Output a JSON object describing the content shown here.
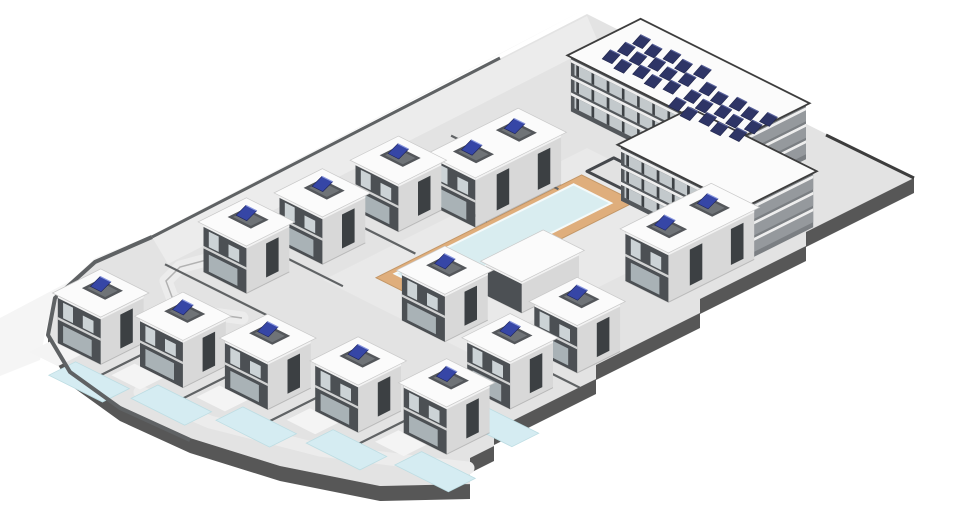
{
  "meta": {
    "canvas": {
      "w": 980,
      "h": 523
    }
  },
  "iso": {
    "ox": 587,
    "oy": 14,
    "ax": 0.894,
    "ay": 0.447
  },
  "palette": {
    "bg": "#ffffff",
    "terrain": "#f5f5f5",
    "plate": "#e3e3e3",
    "plate_side": "#575757",
    "road": "#ececec",
    "road_edge": "#9a9a9a",
    "plaza": "#e9e9e9",
    "deck": "#dfae7c",
    "deck_edge": "#c49767",
    "pool_water": "#d9edf0",
    "pool_edge": "#f4fafa",
    "front_pool": "#d5ecf2",
    "front_pool_edge": "#bddde3",
    "patio": "#f4f4f4",
    "wall": "#5f6264",
    "divider": "#606365",
    "face_sw": "#4c5054",
    "face_se": "#d8d8d8",
    "window_dark": "#3c4043",
    "window_light": "#ccd3d6",
    "glass": "#a9b2b6",
    "fascia": "#f2f2f2",
    "roof": "#fbfbfb",
    "roof_edge": "#c9c9c9",
    "well_wall": "#54575b",
    "well_floor": "#6f7377",
    "solar_house": "#3646a6",
    "solar_house_edge": "#1d2359",
    "solar_house_hi": "#8c9ae0",
    "apt_sw": "#53575b",
    "apt_se": "#7b7f83",
    "apt_bay": "#c3c9cc",
    "apt_pier": "#3e4246",
    "apt_slab": "#eeeeee",
    "parapet": "#3d3d3d",
    "solar_apt": "#2e3566",
    "solar_apt_edge": "#20254a",
    "court": "#45484c",
    "base_line": "rgba(0,0,0,0.16)"
  },
  "site": {
    "terrain_outline": [
      [
        0,
        318
      ],
      [
        587,
        8
      ],
      [
        152,
        235
      ],
      [
        95,
        258
      ],
      [
        55,
        296
      ],
      [
        45,
        333
      ],
      [
        40,
        360
      ],
      [
        0,
        376
      ]
    ],
    "plate_outline": [
      [
        152,
        237
      ],
      [
        587,
        14
      ],
      [
        914,
        178
      ],
      [
        806,
        232
      ],
      [
        806,
        246
      ],
      [
        700,
        299
      ],
      [
        700,
        313
      ],
      [
        596,
        365
      ],
      [
        596,
        379
      ],
      [
        494,
        430
      ],
      [
        494,
        446
      ],
      [
        470,
        458
      ],
      [
        470,
        484
      ],
      [
        380,
        486
      ],
      [
        280,
        466
      ],
      [
        190,
        438
      ],
      [
        120,
        406
      ],
      [
        70,
        370
      ],
      [
        48,
        333
      ],
      [
        56,
        296
      ],
      [
        95,
        260
      ]
    ],
    "south_boundary": [
      [
        914,
        178
      ],
      [
        806,
        232
      ],
      [
        806,
        246
      ],
      [
        700,
        299
      ],
      [
        700,
        313
      ],
      [
        596,
        365
      ],
      [
        596,
        379
      ],
      [
        494,
        430
      ],
      [
        494,
        446
      ],
      [
        470,
        458
      ],
      [
        470,
        484
      ],
      [
        380,
        486
      ],
      [
        280,
        466
      ],
      [
        190,
        438
      ],
      [
        120,
        406
      ],
      [
        70,
        370
      ],
      [
        48,
        333
      ]
    ],
    "band_h": 15,
    "nw_road": [
      [
        587,
        16
      ],
      [
        152,
        237
      ],
      [
        168,
        264
      ],
      [
        599,
        44
      ]
    ],
    "loop_road": [
      [
        242,
        318
      ],
      [
        198,
        312
      ],
      [
        172,
        297
      ],
      [
        166,
        281
      ],
      [
        180,
        267
      ],
      [
        210,
        259
      ],
      [
        242,
        261
      ]
    ],
    "bottom_path": [
      [
        140,
        392
      ],
      [
        210,
        422
      ],
      [
        320,
        450
      ],
      [
        430,
        464
      ],
      [
        468,
        468
      ]
    ],
    "nw_wall": [
      [
        500,
        58
      ],
      [
        152,
        237
      ]
    ],
    "west_curve_wall": [
      [
        152,
        237
      ],
      [
        95,
        262
      ],
      [
        55,
        298
      ],
      [
        48,
        335
      ],
      [
        70,
        372
      ],
      [
        120,
        408
      ],
      [
        190,
        440
      ]
    ],
    "ne_parapet": [
      [
        914,
        178
      ],
      [
        826,
        135
      ]
    ]
  },
  "plaza": {
    "u0": 150,
    "v0": 150,
    "u1": 445,
    "v1": 312
  },
  "deck": {
    "u0": 183,
    "v0": 177,
    "u1": 413,
    "v1": 237
  },
  "pool": {
    "u0": 198,
    "v0": 183,
    "u1": 398,
    "v1": 225
  },
  "courtyard": {
    "u0": 146,
    "v0": 176,
    "u1": 176,
    "v1": 266
  },
  "house_dims": {
    "single": {
      "du": 48,
      "dv": 48,
      "h": 50,
      "wells": [
        [
          -5,
          -3
        ]
      ]
    },
    "duplex": {
      "du": 96,
      "dv": 48,
      "h": 52,
      "wells": [
        [
          -24,
          -2
        ],
        [
          24,
          -2
        ]
      ]
    },
    "box": {
      "du": 64,
      "dv": 40,
      "h": 34,
      "wells": []
    }
  },
  "houses": [
    {
      "id": "house-1",
      "type": "single",
      "u": 479,
      "v": 98
    },
    {
      "id": "house-2",
      "type": "single",
      "u": 404,
      "v": 108
    },
    {
      "id": "house-3",
      "type": "single",
      "u": 325,
      "v": 114
    },
    {
      "id": "duplex-west",
      "type": "duplex",
      "u": 253,
      "v": 152
    },
    {
      "id": "house-4",
      "type": "single",
      "u": 422,
      "v": 263
    },
    {
      "id": "duplex-east",
      "type": "duplex",
      "u": 229,
      "v": 344
    },
    {
      "id": "house-5",
      "type": "single",
      "u": 383,
      "v": 372
    },
    {
      "id": "pool-house",
      "type": "box",
      "u": 339,
      "v": 278
    },
    {
      "id": "house-b1",
      "type": "single",
      "u": 640,
      "v": 96,
      "pool": true
    },
    {
      "id": "house-b2",
      "type": "single",
      "u": 620,
      "v": 168,
      "pool": true
    },
    {
      "id": "house-b3",
      "type": "single",
      "u": 597,
      "v": 240,
      "pool": true
    },
    {
      "id": "house-b4",
      "type": "single",
      "u": 572,
      "v": 316,
      "pool": true
    },
    {
      "id": "house-b5",
      "type": "single",
      "u": 547,
      "v": 390,
      "pool": true
    },
    {
      "id": "house-b6",
      "type": "single",
      "u": 461,
      "v": 375,
      "pool": true
    }
  ],
  "front_pool_dims": {
    "ou0": 35,
    "ov0": 7,
    "ou1": 65,
    "ov1": 67
  },
  "patio_dims": {
    "ou0": 24,
    "ov0": -30,
    "ou1": 50,
    "ov1": 2
  },
  "apartment": {
    "wings": [
      {
        "id": "apartment-wing-west",
        "u0": 40,
        "u1": 118,
        "v0": 100,
        "v1": 285,
        "h": 56,
        "cluster": {
          "u": 84,
          "v": 162,
          "rows": 3,
          "cols": 5,
          "step": 17
        }
      },
      {
        "id": "apartment-wing-east",
        "u0": 112,
        "u1": 190,
        "v0": 228,
        "v1": 365,
        "h": 56,
        "cluster": {
          "u": 100,
          "v": 252,
          "rows": 3,
          "cols": 5,
          "step": 17
        }
      }
    ],
    "floors": 3,
    "bay_step": 17
  },
  "dividers": [
    {
      "u0": 516,
      "v0": 44,
      "u1": 516,
      "v1": 168
    },
    {
      "u0": 441,
      "v0": 44,
      "u1": 441,
      "v1": 168
    },
    {
      "u0": 364,
      "v0": 48,
      "u1": 364,
      "v1": 172
    },
    {
      "u0": 288,
      "v0": 52,
      "u1": 288,
      "v1": 176
    },
    {
      "u0": 212,
      "v0": 60,
      "u1": 212,
      "v1": 180
    },
    {
      "u0": 585,
      "v0": 132,
      "u1": 700,
      "v1": 132
    },
    {
      "u0": 565,
      "v0": 204,
      "u1": 678,
      "v1": 204
    },
    {
      "u0": 540,
      "v0": 278,
      "u1": 652,
      "v1": 278
    },
    {
      "u0": 515,
      "v0": 353,
      "u1": 625,
      "v1": 353
    },
    {
      "u0": 504,
      "v0": 340,
      "u1": 504,
      "v1": 424
    },
    {
      "u0": 422,
      "v0": 330,
      "u1": 422,
      "v1": 414
    }
  ]
}
